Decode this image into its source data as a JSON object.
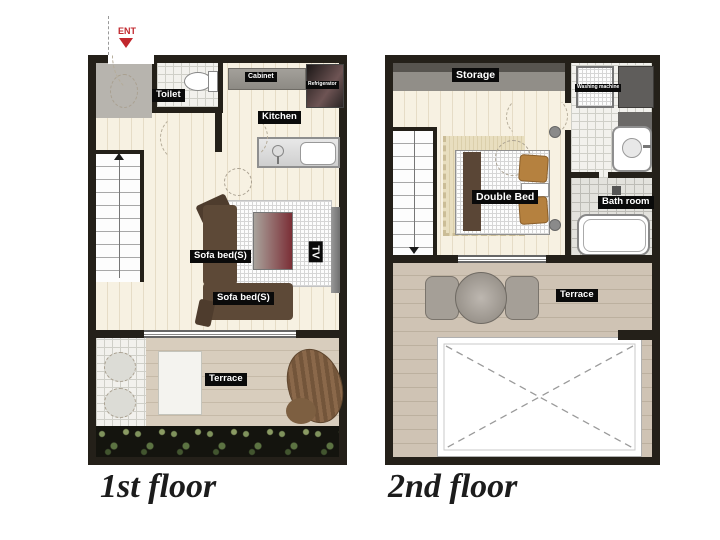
{
  "palette": {
    "wall": "#242019",
    "wood_floor": "#f7f1e2",
    "terrace_deck": "#d8cdbd",
    "sofa_brown": "#5d4937",
    "pillow_caramel": "#b5813f",
    "label_bg": "#0a0a0a",
    "label_text": "#ffffff",
    "ent_red": "#c1272d",
    "storage_gray": "#918e88",
    "table_maroon": "#7b2e36"
  },
  "floor1": {
    "caption": "1st floor",
    "entrance": {
      "label": "ENT"
    },
    "labels": {
      "toilet": "Toilet",
      "cabinet": "Cabinet",
      "refrigerator": "Refrigerator",
      "kitchen": "Kitchen",
      "sofa_bed_a": "Sofa bed(S)",
      "sofa_bed_b": "Sofa bed(S)",
      "tv": "TV",
      "terrace": "Terrace"
    }
  },
  "floor2": {
    "caption": "2nd floor",
    "labels": {
      "storage": "Storage",
      "washing_machine": "Washing machine",
      "double_bed": "Double Bed",
      "bath_room": "Bath room",
      "terrace": "Terrace"
    }
  }
}
